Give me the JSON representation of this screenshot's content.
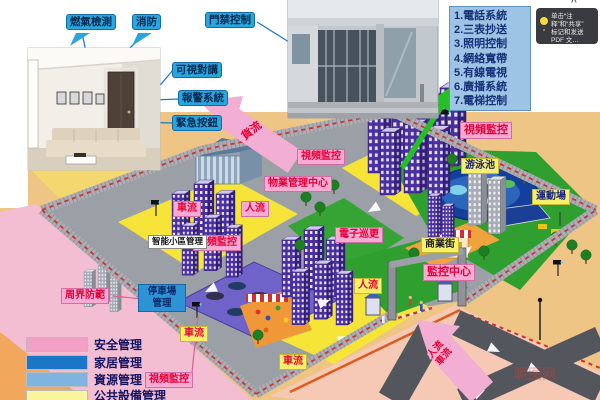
{
  "callouts": {
    "gas_detection": "燃氣檢測",
    "fire_protection": "消防",
    "access_control": "門禁控制",
    "video_intercom": "可視對講",
    "alarm_system": "報警系統",
    "emergency_button": "緊急按鈕"
  },
  "systems_panel": {
    "items": [
      "1.電話系統",
      "2.三表抄送",
      "3.照明控制",
      "4.網絡寬帶",
      "5.有線電視",
      "6.廣播系統",
      "7.電梯控制"
    ]
  },
  "tooltip": {
    "chevron": "^",
    "line1": "单击“注释”和“共享”",
    "line2": "标记和发送 PDF 文…"
  },
  "map_labels": {
    "video_surveillance_top": "視頻監控",
    "video_surveillance_right": "視頻監控",
    "video_surveillance_mid": "視頻監控",
    "video_surveillance_bottom": "視頻監控",
    "property_mgmt_center": "物業管理中心",
    "smart_community_mgmt": "智能小區管理",
    "parking_mgmt_line1": "停車場",
    "parking_mgmt_line2": "管理",
    "perimeter_defense": "周界防範",
    "electronic_patrol": "電子巡更",
    "monitoring_center": "監控中心",
    "commercial_street": "商業街",
    "swimming_pool": "游泳池",
    "sports_field": "運動場"
  },
  "flow_labels": {
    "goods_flow": "貨流",
    "people_flow": "人流",
    "vehicle_flow": "車流",
    "people_flow_2": "人流",
    "vehicle_flow_2": "車流",
    "vehicle_flow_3": "車流",
    "gate_people_flow": "人流",
    "gate_vehicle_flow": "車流"
  },
  "legend": {
    "items": [
      {
        "label": "安全管理",
        "color": "#f2a0c6"
      },
      {
        "label": "家居管理",
        "color": "#1c76c8"
      },
      {
        "label": "資源管理",
        "color": "#7fb3e0"
      },
      {
        "label": "公共設備管理",
        "color": "#f8f59a"
      }
    ]
  },
  "watermark": "昵图网",
  "colors": {
    "pink_label_bg": "#f9abd4",
    "yellow_label_bg": "#f8f06a",
    "red_text": "#e40038",
    "blue_callout_bg": "#2aa6de",
    "systems_panel_bg": "#9ec4e4",
    "parking_box_bg": "#2e93d4",
    "green_arrow": "#23c125",
    "outer_pink": "#f4bed2",
    "outer_tan": "#eec584"
  }
}
